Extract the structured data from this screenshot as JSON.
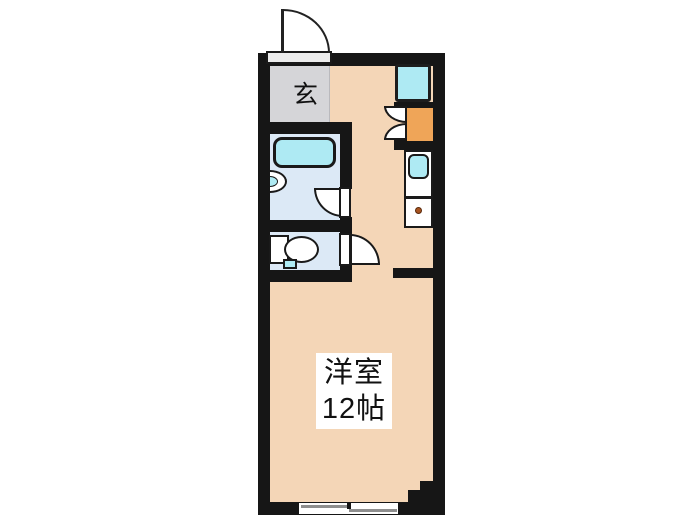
{
  "plan": {
    "title": "studio-apartment-floor-plan",
    "entrance": {
      "label": "玄"
    },
    "main_room": {
      "name": "洋室",
      "size": "12帖"
    },
    "fixtures": [
      "entrance-door",
      "washer-space",
      "refrigerator-space",
      "refrigerator-door-swing",
      "kitchen-counter",
      "kitchen-sink",
      "stove-burner",
      "bathtub",
      "washbasin",
      "bathroom-door",
      "toilet",
      "toilet-door",
      "sliding-window",
      "structural-pillar"
    ],
    "colors": {
      "wall": "#161616",
      "room_floor": "#f4d6b7",
      "entrance_floor": "#d5d5d8",
      "wet_area_floor": "#dce9f6",
      "fixture_cyan": "#aeeaf3",
      "appliance_orange": "#efa558",
      "window_gray": "#8e8e8e",
      "burner_dot": "#a85420",
      "background": "#ffffff"
    }
  }
}
